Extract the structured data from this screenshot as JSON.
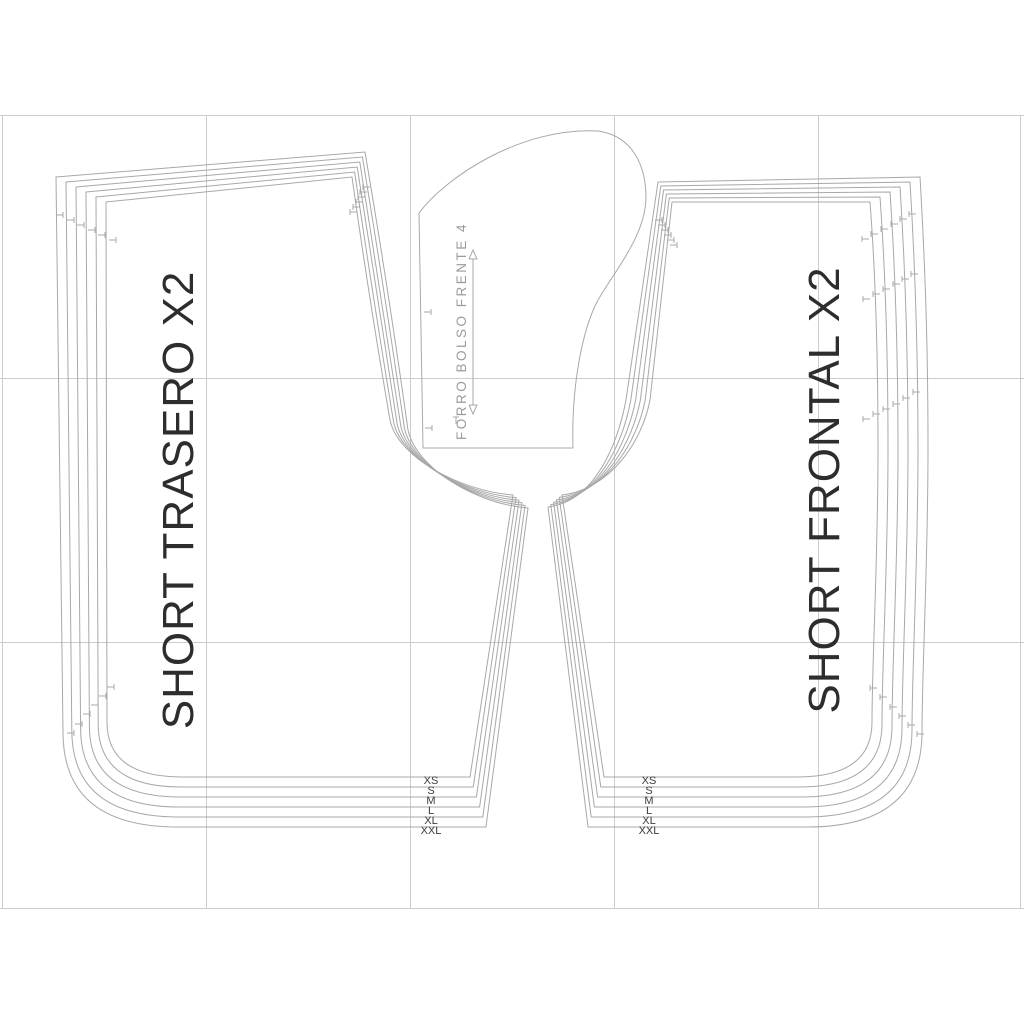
{
  "pieces": {
    "back": {
      "label": "SHORT TRASERO X2"
    },
    "front": {
      "label": "SHORT FRONTAL X2"
    },
    "pocket": {
      "label": "FORRO BOLSO FRENTE 4"
    }
  },
  "sizes": [
    "XS",
    "S",
    "M",
    "L",
    "XL",
    "XXL"
  ],
  "colors": {
    "outline": "#a8a8a8",
    "grid": "#cccccc",
    "label_text": "#2d2d2d",
    "size_label_text": "#3c3c3c",
    "pocket_text": "#9b9b9b"
  }
}
